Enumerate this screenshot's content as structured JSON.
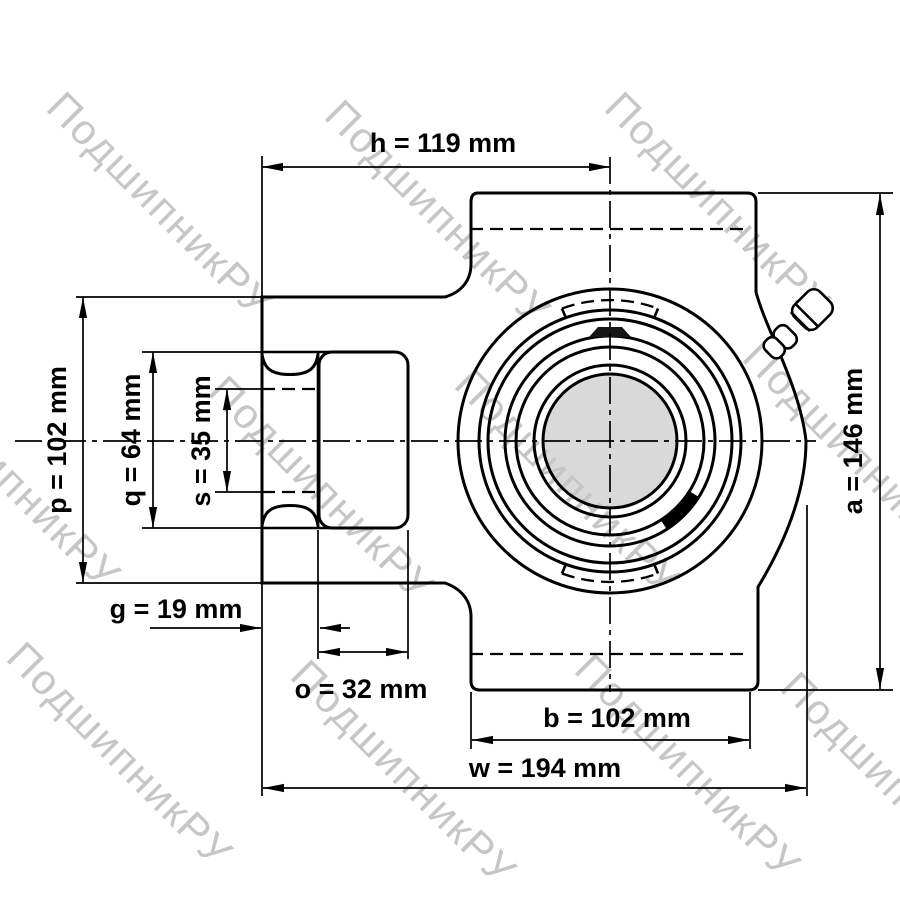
{
  "drawing": {
    "dims": {
      "h": "h = 119 mm",
      "p": "p = 102 mm",
      "q": "q = 64 mm",
      "s": "s = 35 mm",
      "g": "g = 19 mm",
      "o": "o = 32 mm",
      "b": "b = 102 mm",
      "w": "w = 194 mm",
      "a": "a = 146 mm"
    },
    "watermark": {
      "text": "ПодшипникРУ",
      "color": "#c6c6c6"
    },
    "colors": {
      "line": "#000000",
      "bore_fill": "#d9d9d9",
      "background": "#ffffff"
    }
  }
}
